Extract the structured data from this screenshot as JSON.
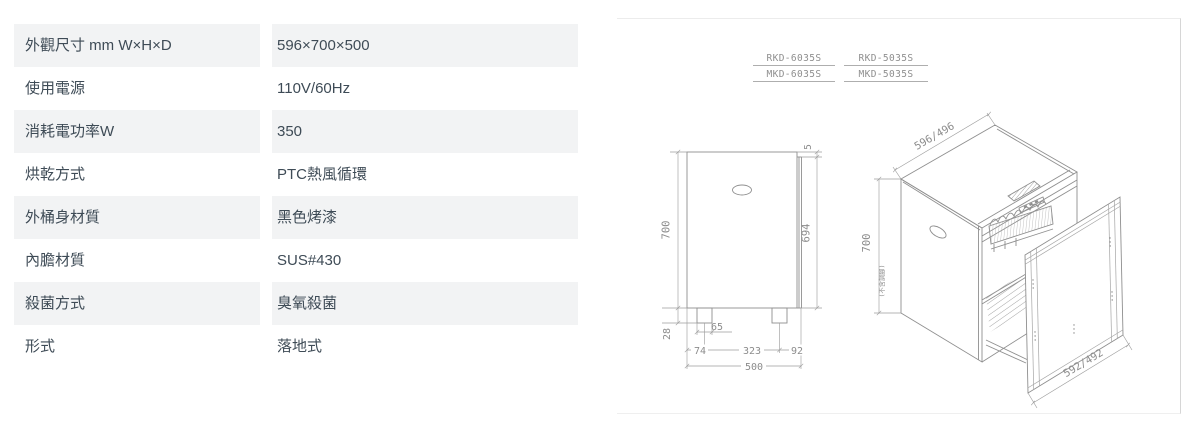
{
  "spec_table": {
    "rows": [
      {
        "label": "外觀尺寸 mm W×H×D",
        "value": "596×700×500"
      },
      {
        "label": "使用電源",
        "value": "110V/60Hz"
      },
      {
        "label": "消耗電功率W",
        "value": "350"
      },
      {
        "label": "烘乾方式",
        "value": "PTC熱風循環"
      },
      {
        "label": "外桶身材質",
        "value": "黑色烤漆"
      },
      {
        "label": "內膽材質",
        "value": "SUS#430"
      },
      {
        "label": "殺菌方式",
        "value": "臭氧殺菌"
      },
      {
        "label": "形式",
        "value": "落地式"
      }
    ]
  },
  "diagram": {
    "models": [
      "RKD-6035S",
      "RKD-5035S",
      "MKD-6035S",
      "MKD-5035S"
    ],
    "side_view": {
      "height": "700",
      "door_gap": "5",
      "door_height": "694",
      "base_height": "28",
      "foot_width": "65",
      "foot_front_offset": "74",
      "foot_spacing": "323",
      "foot_rear_offset": "92",
      "depth": "500"
    },
    "iso_view": {
      "top_width": "596/496",
      "height": "700",
      "height_note": "(不含調腳)",
      "door_width": "592/492"
    }
  },
  "colors": {
    "row_shade": "#f2f3f4",
    "table_text": "#3e4b56",
    "drawing_line": "#8f8f8f",
    "dim_text": "#8c8c8c"
  }
}
